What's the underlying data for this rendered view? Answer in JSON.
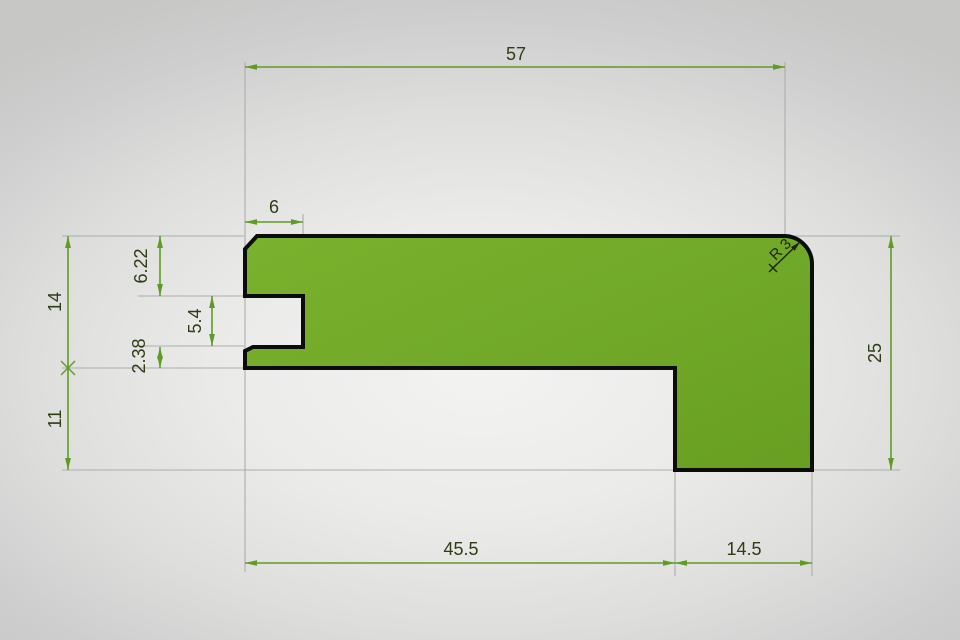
{
  "drawing": {
    "type": "technical-profile-drawing",
    "dimensions": {
      "top_width": "57",
      "groove_width": "6",
      "upper_left": "6.22",
      "left_height_upper": "14",
      "groove_height": "5.4",
      "lower_lip": "2.38",
      "left_height_lower": "11",
      "right_height": "25",
      "bottom_left_width": "45.5",
      "bottom_right_width": "14.5",
      "corner_radius": "R 3"
    },
    "colors": {
      "shape_fill": "#73aa28",
      "shape_outline": "#0c0c0c",
      "dimension_line": "#5f9c26",
      "dimension_text": "#2e3d14",
      "extension_line": "#adadac",
      "background_center": "#f2f2f1",
      "background_edge": "#c7c7c6"
    }
  }
}
